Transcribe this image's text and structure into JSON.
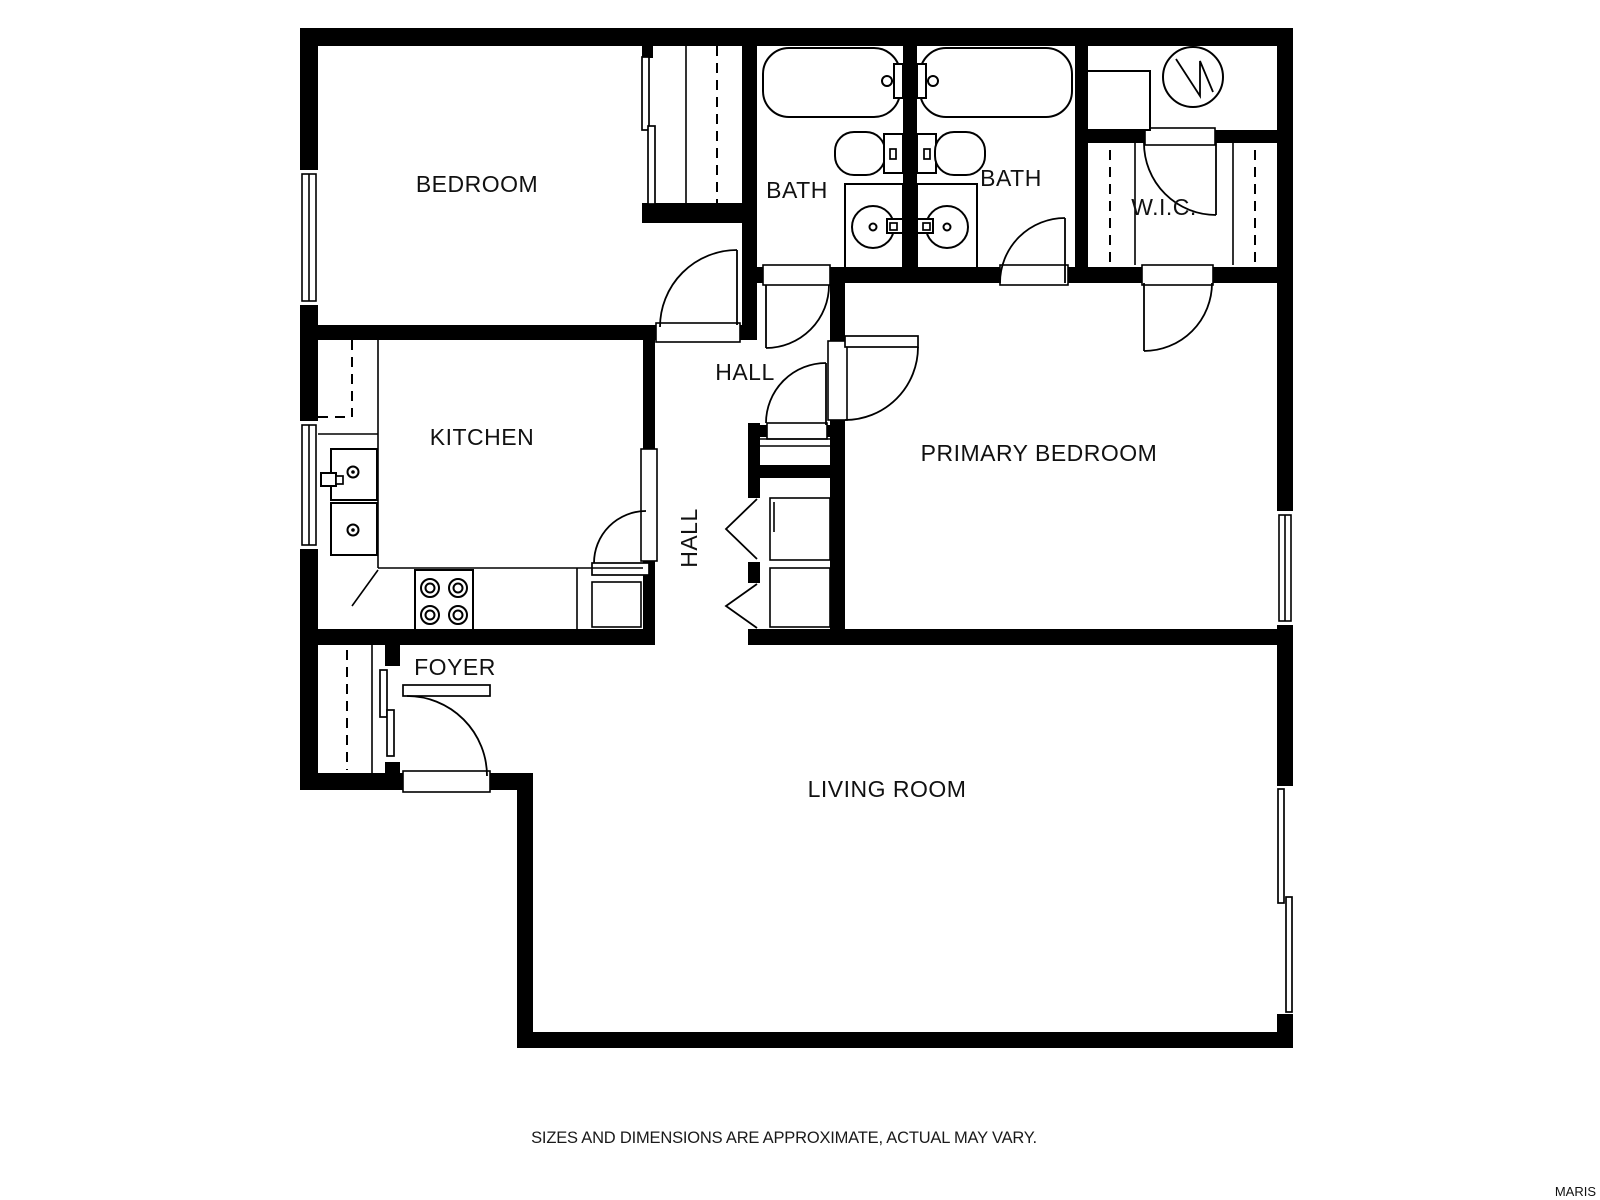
{
  "canvas": {
    "width": 1600,
    "height": 1200,
    "background": "#ffffff"
  },
  "plan": {
    "wall_color": "#000000",
    "line_color": "#000000",
    "rooms": [
      {
        "id": "bedroom",
        "label": "BEDROOM"
      },
      {
        "id": "bath-1",
        "label": "BATH"
      },
      {
        "id": "bath-2",
        "label": "BATH"
      },
      {
        "id": "walk-in-closet",
        "label": "W.I.C."
      },
      {
        "id": "kitchen",
        "label": "KITCHEN"
      },
      {
        "id": "hall-upper",
        "label": "HALL"
      },
      {
        "id": "hall-lower",
        "label": "HALL"
      },
      {
        "id": "primary-bedroom",
        "label": "PRIMARY BEDROOM"
      },
      {
        "id": "foyer",
        "label": "FOYER"
      },
      {
        "id": "living-room",
        "label": "LIVING ROOM"
      }
    ]
  },
  "footer": {
    "disclaimer": "SIZES AND DIMENSIONS ARE APPROXIMATE, ACTUAL MAY VARY."
  },
  "watermark": {
    "text": "MARIS",
    "color": "#c9c9c9"
  }
}
